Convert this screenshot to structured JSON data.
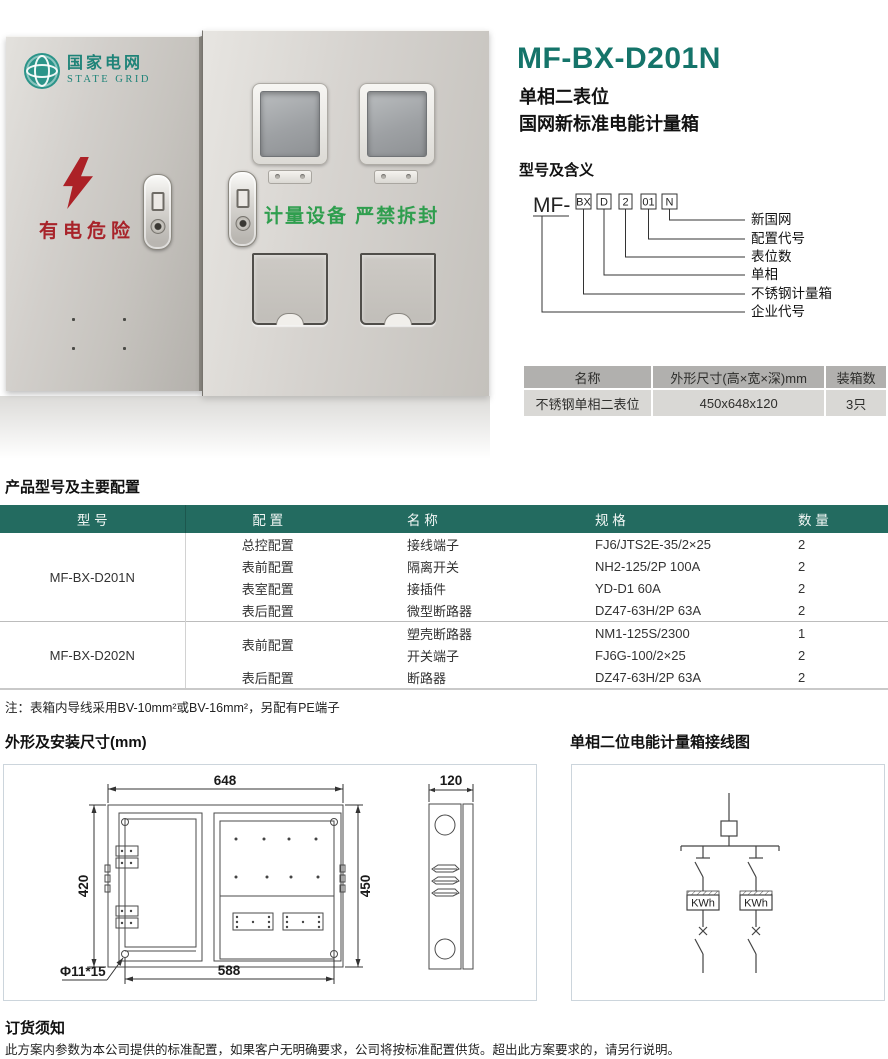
{
  "header": {
    "model": "MF-BX-D201N",
    "subtitle1": "单相二表位",
    "subtitle2": "国网新标准电能计量箱"
  },
  "photo": {
    "brand_cn": "国家电网",
    "brand_en": "STATE GRID",
    "danger_text": "有电危险",
    "seal_text": "计量设备 严禁拆封"
  },
  "model_meaning": {
    "heading": "型号及含义",
    "prefix": "MF-",
    "codes": [
      "BX",
      "D",
      "2",
      "01",
      "N"
    ],
    "labels": [
      "新国网",
      "配置代号",
      "表位数",
      "单相",
      "不锈钢计量箱",
      "企业代号"
    ]
  },
  "spec_table": {
    "col_name": "名称",
    "col_size": "外形尺寸(高×宽×深)mm",
    "col_pack": "装箱数",
    "row_name": "不锈钢单相二表位",
    "row_size": "450x648x120",
    "row_pack": "3只"
  },
  "config": {
    "heading": "产品型号及主要配置",
    "col_model": "型 号",
    "col_config": "配 置",
    "col_name": "名 称",
    "col_spec": "规 格",
    "col_qty": "数 量",
    "groups": [
      {
        "model": "MF-BX-D201N",
        "rows": [
          {
            "config": "总控配置",
            "name": "接线端子",
            "spec": "FJ6/JTS2E-35/2×25",
            "qty": "2"
          },
          {
            "config": "表前配置",
            "name": "隔离开关",
            "spec": "NH2-125/2P 100A",
            "qty": "2"
          },
          {
            "config": "表室配置",
            "name": "接插件",
            "spec": "YD-D1 60A",
            "qty": "2"
          },
          {
            "config": "表后配置",
            "name": "微型断路器",
            "spec": "DZ47-63H/2P 63A",
            "qty": "2"
          }
        ]
      },
      {
        "model": "MF-BX-D202N",
        "rows": [
          {
            "config": "表前配置",
            "name": "塑壳断路器",
            "spec": "NM1-125S/2300",
            "qty": "1"
          },
          {
            "name": "开关端子",
            "spec": "FJ6G-100/2×25",
            "qty": "2"
          },
          {
            "config": "表后配置",
            "name": "断路器",
            "spec": "DZ47-63H/2P 63A",
            "qty": "2"
          }
        ]
      }
    ],
    "note": "注：表箱内导线采用BV-10mm²或BV-16mm²，另配有PE端子"
  },
  "dims": {
    "heading": "外形及安装尺寸(mm)",
    "width": "648",
    "height_left": "420",
    "height_right": "450",
    "bottom_width": "588",
    "hole": "Φ11*15",
    "depth": "120"
  },
  "wiring": {
    "heading": "单相二位电能计量箱接线图",
    "meter_label": "KWh"
  },
  "order": {
    "heading": "订货须知",
    "text": "此方案内参数为本公司提供的标准配置，如果客户无明确要求，公司将按标准配置供货。超出此方案要求的，请另行说明。"
  }
}
